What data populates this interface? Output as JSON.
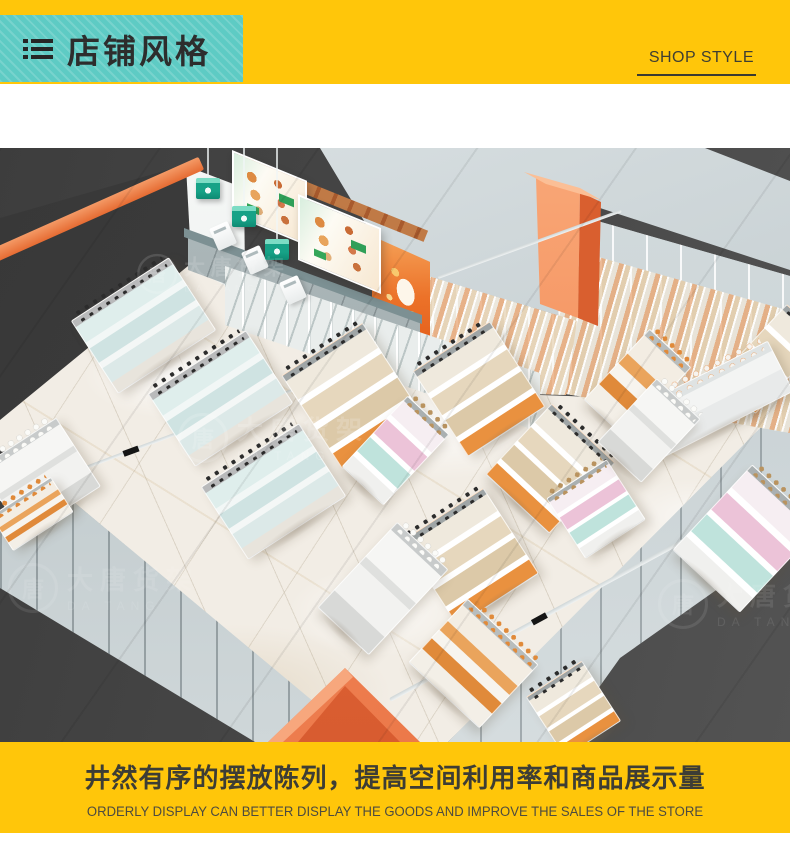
{
  "header": {
    "icon": "list-icon",
    "title_cn": "店铺风格",
    "title_en": "SHOP STYLE"
  },
  "scene": {
    "type": "3d-isometric-store-render",
    "watermark": {
      "logo_char": "唐",
      "brand_cn": "大唐货架",
      "brand_en": "DA TANG"
    }
  },
  "footer": {
    "caption_cn": "井然有序的摆放陈列，提高空间利用率和商品展示量",
    "caption_en": "ORDERLY DISPLAY CAN BETTER DISPLAY THE GOODS AND IMPROVE THE SALES OF THE STORE"
  },
  "colors": {
    "banner_yellow": "#FFC60A",
    "title_teal": "#5ECBC4",
    "accent_orange": "#ED7243",
    "scene_dark": "#454545",
    "lamp_teal": "#17A287",
    "floor_marble": "#F2EDE5"
  }
}
